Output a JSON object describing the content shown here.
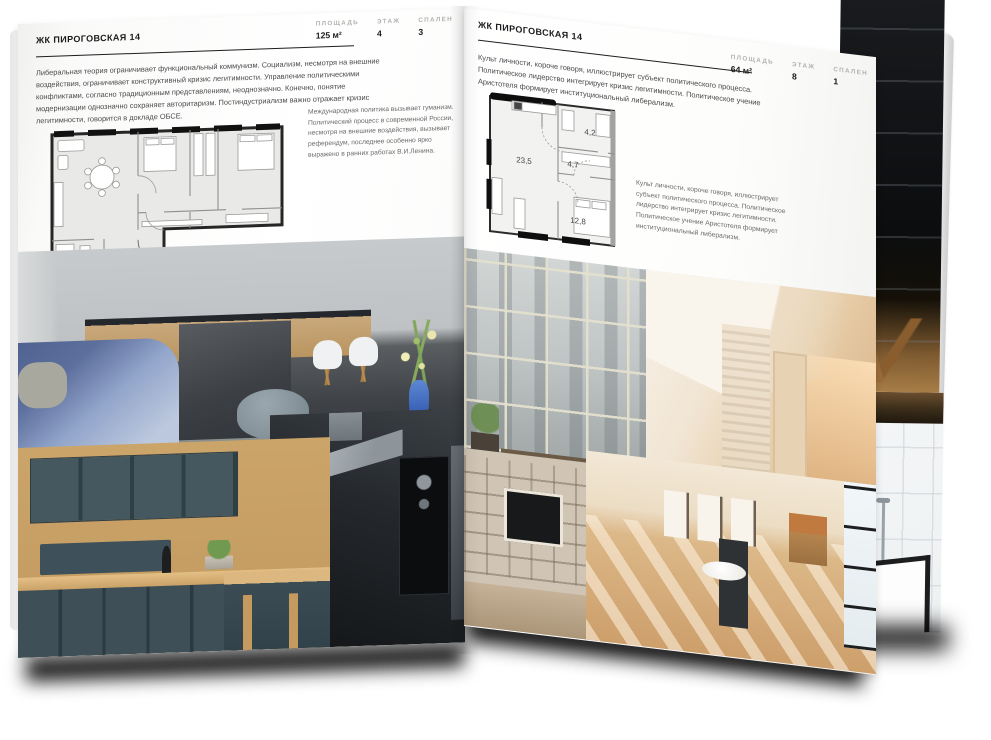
{
  "left_page": {
    "header": "ЖК ПИРОГОВСКАЯ 14",
    "stats": [
      {
        "label": "ПЛОЩАДЬ",
        "value": "125 м²"
      },
      {
        "label": "ЭТАЖ",
        "value": "4"
      },
      {
        "label": "СПАЛЕН",
        "value": "3"
      }
    ],
    "intro": "Либеральная теория ограничивает функциональный коммунизм. Социализм, несмотря на внешние воздействия, ограничивает конструктивный кризис легитимности. Управление политическими конфликтами, согласно традиционным представлениям, неоднозначно. Конечно, понятие модернизации однозначно сохраняет авторитаризм. Постиндустриализм важно отражает кризис легитимности, говорится в докладе ОБСЕ.",
    "note": "Международная политика вызывает гуманизм. Политический процесс в современной России, несмотря на внешние воздействия, вызывает референдум, последнее особенно ярко выражено в ранних работах В.И.Ленина."
  },
  "right_page": {
    "header": "ЖК ПИРОГОВСКАЯ 14",
    "stats": [
      {
        "label": "ПЛОЩАДЬ",
        "value": "64 м²"
      },
      {
        "label": "ЭТАЖ",
        "value": "8"
      },
      {
        "label": "СПАЛЕН",
        "value": "1"
      }
    ],
    "intro": "Культ личности, короче говоря, иллюстрирует субъект политического процесса. Политическое лидерство интегрирует кризис легитимности. Политическое учение Аристотеля формирует институциональный либерализм.",
    "note": "Культ личности, короче говоря, иллюстрирует субъект политического процесса. Политическое лидерство интегрирует кризис легитимности. Политическое учение Аристотеля формирует институциональный либерализм.",
    "plan": {
      "rooms": [
        "23,5",
        "4,7",
        "4,2",
        "12,8"
      ]
    }
  },
  "photos": {
    "living_room": "living room with kitchen island",
    "hood_kitchen": "dark kitchen with range hood",
    "teal_kitchen": "kitchen with dark teal cabinets and wood",
    "window_wall": "loft window wall with bench",
    "attic_hall": "warm attic hallway with brick wall",
    "bookshelf_living": "living room with bookshelves and TV",
    "sunlit_room": "sunlit room with chairs and frames",
    "dark_stairs": "dark staircase shelf photo (next page)",
    "bathtub": "black-framed bathtub (next page)"
  },
  "palette": {
    "page": "#fbfbfa",
    "ink": "#1c1c1c",
    "body_text": "#4a4a4a",
    "label_gray": "#b2b2b0",
    "plan_wall": "#222222",
    "plan_floor": "#e9e9e7",
    "accent_blue": "#4a79cc",
    "wood": "#c9a06a",
    "cabinet_teal": "#44555c",
    "warm_beige": "#e0c09a"
  }
}
